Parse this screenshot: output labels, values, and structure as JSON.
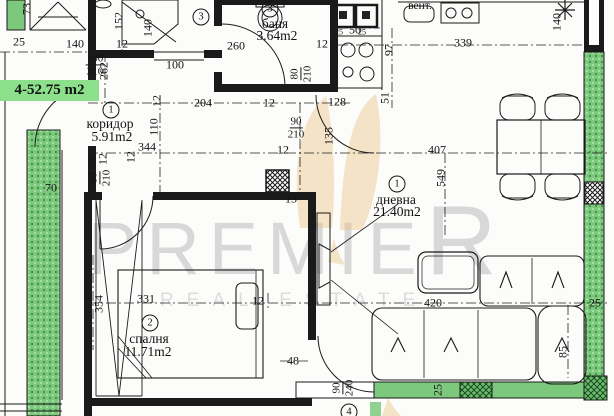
{
  "apartment": {
    "label": "4-52.75 m2"
  },
  "watermark": {
    "brand_main": "PREMIE",
    "brand_last": "R",
    "brand_sub": "REAL ESTATE"
  },
  "rooms": [
    {
      "marker": "1",
      "name": "коридор",
      "area": "5.91m2"
    },
    {
      "marker": "1",
      "name": "дневна",
      "area": "21.40m2"
    },
    {
      "marker": "2",
      "name": "спалня",
      "area": "11.71m2"
    },
    {
      "marker": "3",
      "name": "баня",
      "area": "3.64m2"
    }
  ],
  "extra_markers": {
    "shower": "3",
    "balcony": "4"
  },
  "kitchen": {
    "vent_label": "вент."
  },
  "dimensions": [
    {
      "t": "25",
      "x": 19,
      "y": 42
    },
    {
      "t": "140",
      "x": 75,
      "y": 44
    },
    {
      "t": "12",
      "x": 122,
      "y": 44
    },
    {
      "t": "73",
      "x": 27,
      "y": 9,
      "r": 1
    },
    {
      "t": "152",
      "x": 119,
      "y": 21,
      "r": 1
    },
    {
      "t": "262",
      "x": 104,
      "y": 71,
      "r": 1
    },
    {
      "t": "140",
      "x": 148,
      "y": 28,
      "r": 1
    },
    {
      "t": "260",
      "x": 236,
      "y": 46
    },
    {
      "t": "100",
      "x": 175,
      "y": 65
    },
    {
      "t": "204",
      "x": 203,
      "y": 103
    },
    {
      "t": "12",
      "x": 269,
      "y": 103
    },
    {
      "t": "128",
      "x": 337,
      "y": 102
    },
    {
      "t": "12",
      "x": 322,
      "y": 44
    },
    {
      "t": "50",
      "x": 355,
      "y": 30
    },
    {
      "t": "25",
      "x": 339,
      "y": 32,
      "fs": 8
    },
    {
      "t": "25",
      "x": 362,
      "y": 32,
      "fs": 8
    },
    {
      "t": "339",
      "x": 463,
      "y": 43
    },
    {
      "t": "97",
      "x": 389,
      "y": 50,
      "r": 1
    },
    {
      "t": "51",
      "x": 385,
      "y": 98,
      "r": 1
    },
    {
      "t": "140",
      "x": 557,
      "y": 22,
      "r": 1
    },
    {
      "t": "407",
      "x": 437,
      "y": 150
    },
    {
      "t": "549",
      "x": 441,
      "y": 178,
      "r": 1
    },
    {
      "t": "110",
      "x": 154,
      "y": 127,
      "r": 1
    },
    {
      "t": "12",
      "x": 157,
      "y": 101,
      "r": 1
    },
    {
      "t": "344",
      "x": 147,
      "y": 147
    },
    {
      "t": "12",
      "x": 131,
      "y": 157,
      "r": 1
    },
    {
      "t": "12",
      "x": 283,
      "y": 150
    },
    {
      "t": "135",
      "x": 329,
      "y": 136,
      "r": 1
    },
    {
      "t": "13",
      "x": 291,
      "y": 199
    },
    {
      "t": "70",
      "x": 51,
      "y": 188
    },
    {
      "t": "12",
      "x": 103,
      "y": 159,
      "r": 1
    },
    {
      "t": "354",
      "x": 99,
      "y": 304,
      "r": 1
    },
    {
      "t": "331",
      "x": 146,
      "y": 299
    },
    {
      "t": "12",
      "x": 258,
      "y": 301
    },
    {
      "t": "48",
      "x": 293,
      "y": 361
    },
    {
      "t": "420",
      "x": 433,
      "y": 303
    },
    {
      "t": "25",
      "x": 438,
      "y": 390,
      "r": 1
    },
    {
      "t": "25",
      "x": 595,
      "y": 303
    },
    {
      "t": "85",
      "x": 563,
      "y": 352,
      "r": 1
    }
  ],
  "door_sizes": [
    {
      "a": "100",
      "b": "210",
      "x": 95,
      "y": 65
    },
    {
      "a": "80",
      "b": "210",
      "x": 301,
      "y": 74,
      "r": 1
    },
    {
      "a": "90",
      "b": "210",
      "x": 296,
      "y": 128
    },
    {
      "a": "80",
      "b": "210",
      "x": 100,
      "y": 178,
      "r": 1
    },
    {
      "a": "90",
      "b": "240",
      "x": 343,
      "y": 388,
      "r": 1
    }
  ],
  "colors": {
    "line": "#1a1a1a",
    "green-solid": "#7cc87c",
    "green-label": "#8ce08c",
    "watermark-gray": "#d8d8d8",
    "butterfly-gold": "#eac37e"
  }
}
